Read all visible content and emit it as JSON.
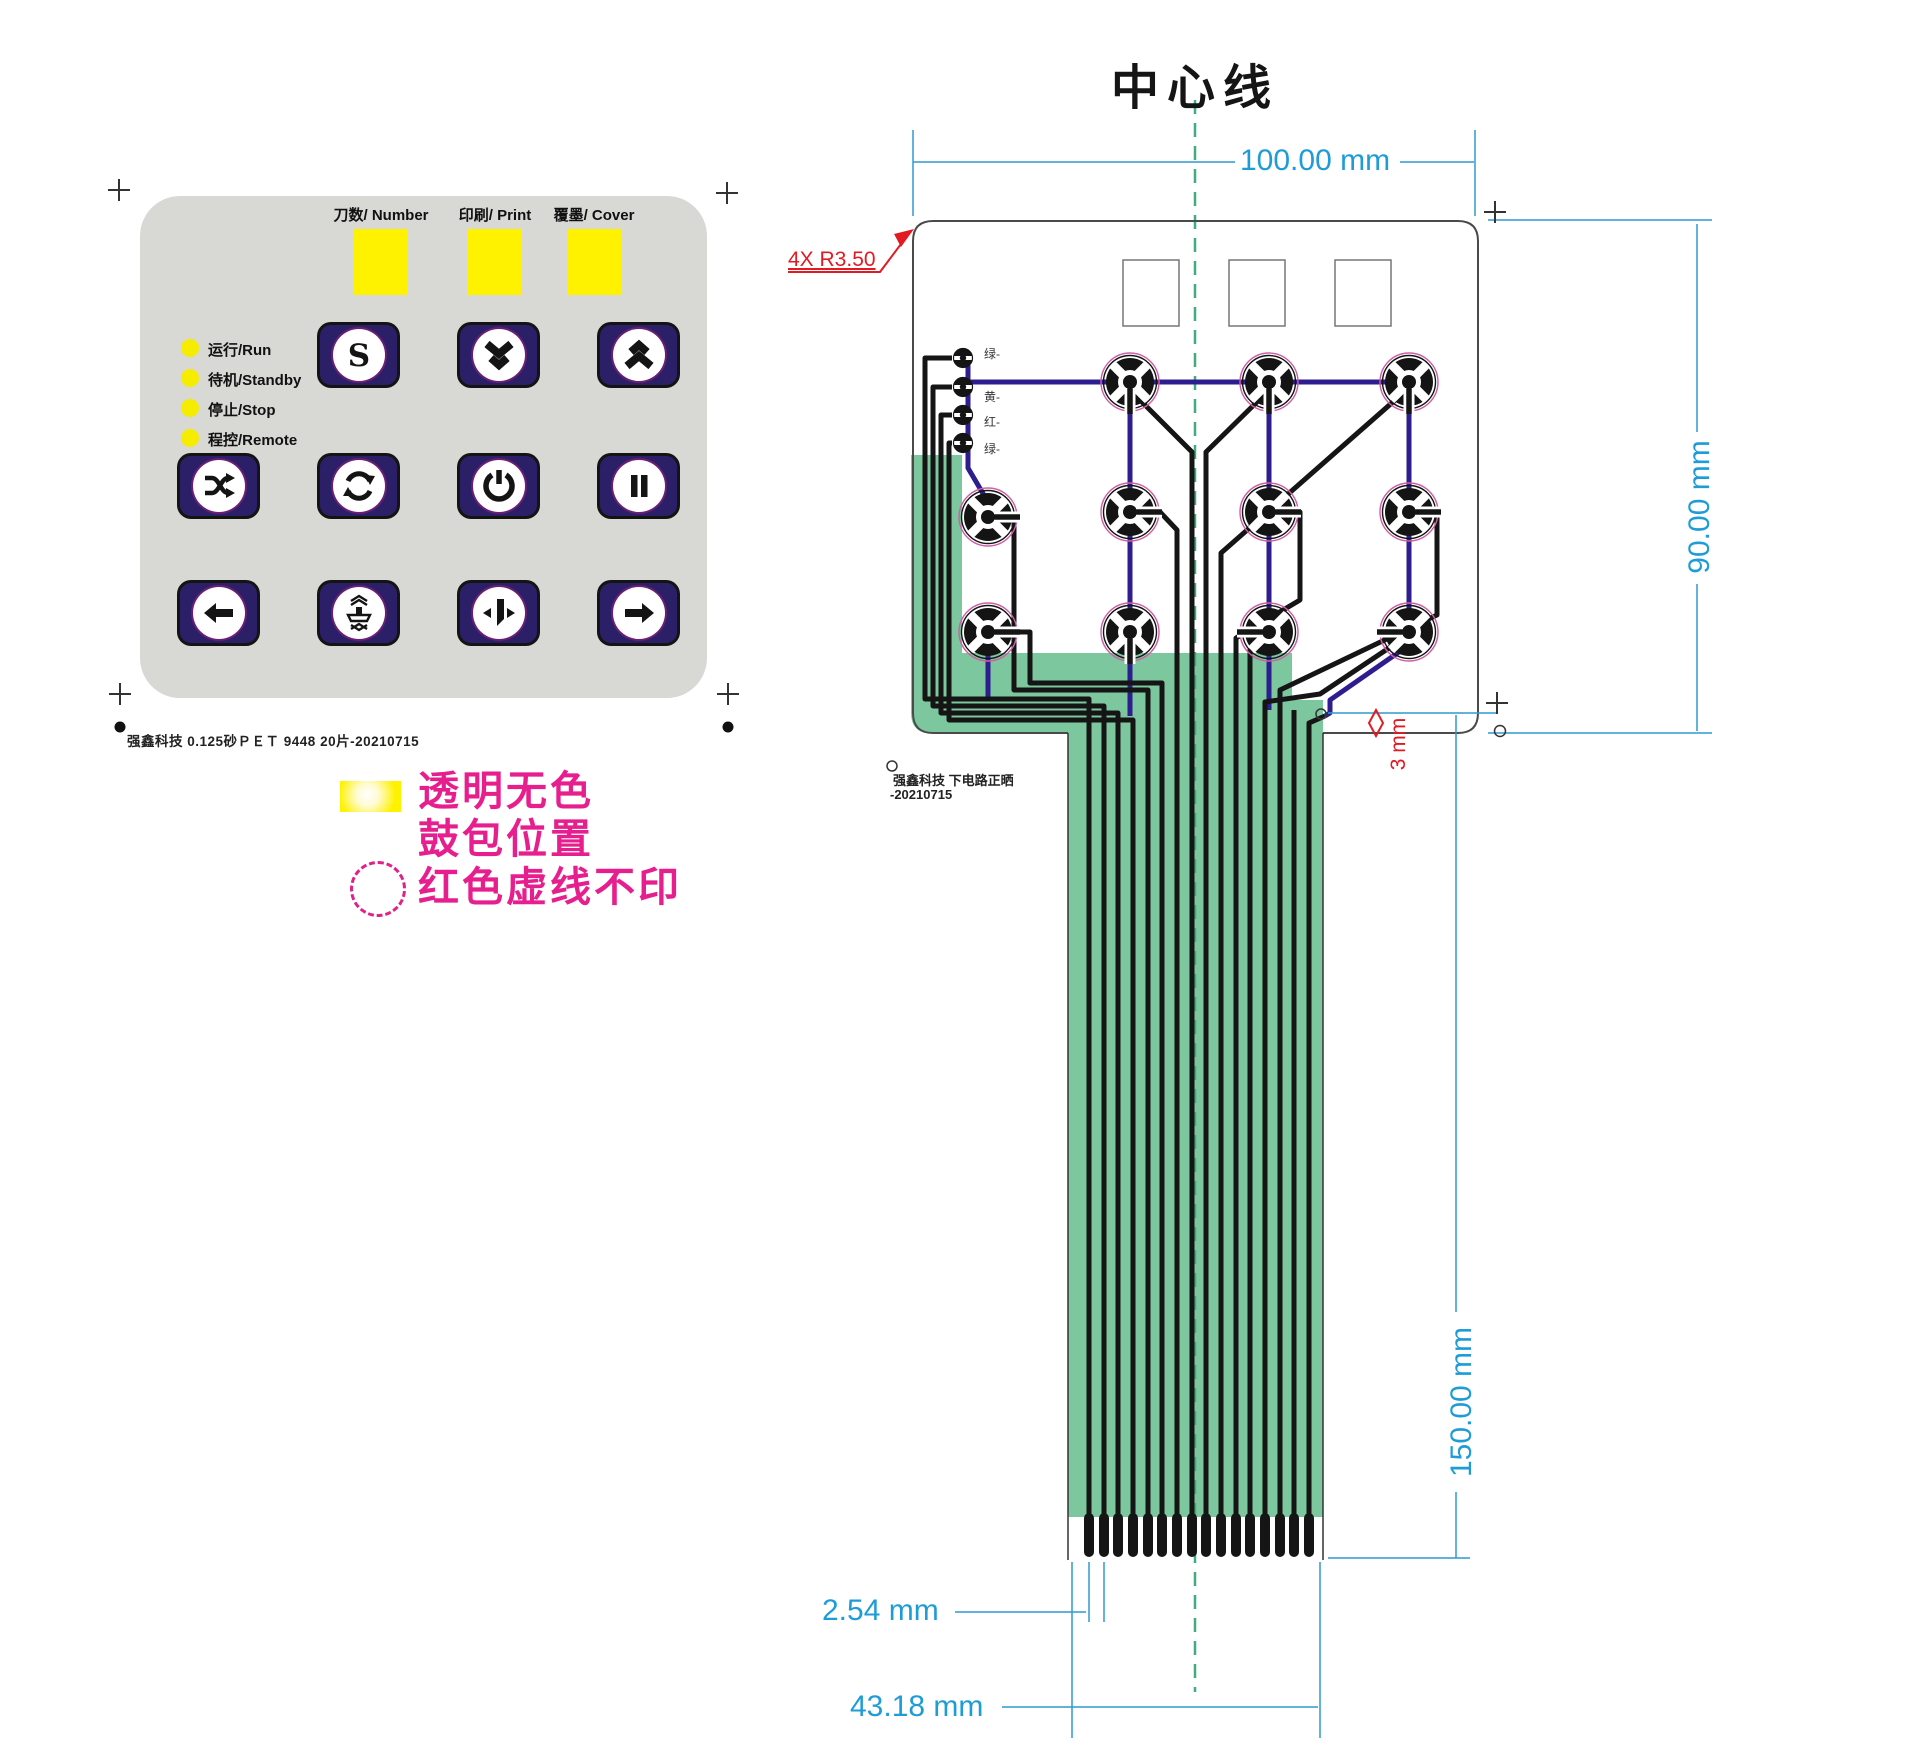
{
  "overlay": {
    "window_labels": [
      "刀数/ Number",
      "印刷/ Print",
      "覆墨/ Cover"
    ],
    "status_leds": [
      "运行/Run",
      "待机/Standby",
      "停止/Stop",
      "程控/Remote"
    ],
    "s_label": "S",
    "keys": [
      "s",
      "double-down",
      "double-up",
      "shuffle",
      "cycle",
      "power",
      "pause",
      "arrow-left",
      "press",
      "cutter",
      "arrow-right"
    ],
    "production_note": "强鑫科技  0.125砂ＰＥＴ  9448  20片-20210715"
  },
  "legend": {
    "line1": "透明无色",
    "line2": "鼓包位置",
    "line3": "红色虚线不印"
  },
  "circuit": {
    "title": "中心线",
    "corner_note": "4X R3.50",
    "led_labels": [
      "绿-",
      "黄-",
      "红-",
      "绿-"
    ],
    "note_line1": "强鑫科技  下电路正晒",
    "note_line2": "-20210715",
    "dims": {
      "width": "100.00 mm",
      "height": "90.00 mm",
      "tail_length": "150.00 mm",
      "pitch": "2.54 mm",
      "tail_width": "43.18 mm",
      "offset": "3 mm"
    }
  },
  "colors": {
    "panel_gray": "#d8d8d4",
    "window_yellow": "#fef200",
    "button_navy": "#2b2068",
    "legend_magenta": "#e71e8d",
    "dimension_blue": "#1e9cd7",
    "annotation_red": "#e11b22",
    "tail_green": "#7cc79e",
    "centerline_green": "#3fae7c",
    "bottom_layer_navy": "#2d1d8e",
    "trace_black": "#151515"
  }
}
